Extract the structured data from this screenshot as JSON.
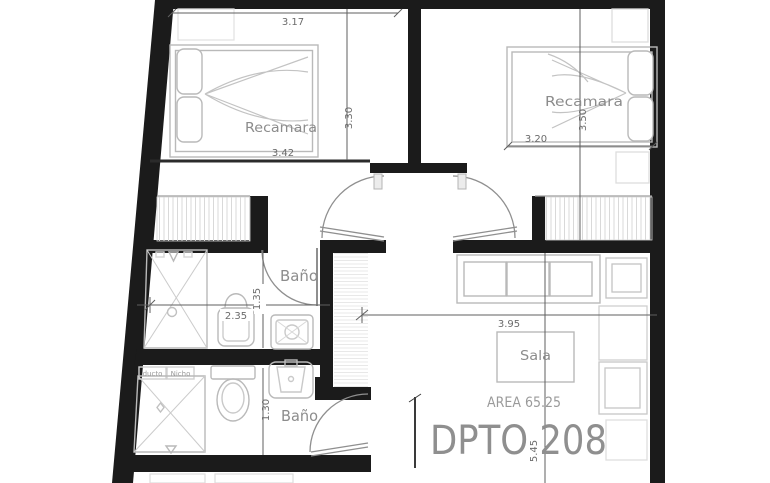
{
  "plan": {
    "unit_label": "DPTO 208",
    "area_label": "AREA 65.25",
    "rooms": {
      "bedroom_left": "Recamara",
      "bedroom_right": "Recamara",
      "bath_upper": "Baño",
      "bath_lower": "Baño",
      "living": "Sala",
      "duct": "ducto",
      "niche": "Nicho"
    },
    "dimensions": {
      "bed1_width_top": "3.17",
      "bed1_width_bottom": "3.42",
      "bed1_height": "3.30",
      "bed2_width": "3.20",
      "bed2_height": "3.50",
      "living_width": "3.95",
      "living_height": "5.45",
      "bath_upper_width": "2.35",
      "bath_upper_height": "1.35",
      "bath_lower_height": "1.30"
    },
    "colors": {
      "wall": "#1b1b1b",
      "furniture_line": "#b9b9b9",
      "label_text": "#8c8c8c",
      "dimension_text": "#6b6b6b"
    }
  }
}
